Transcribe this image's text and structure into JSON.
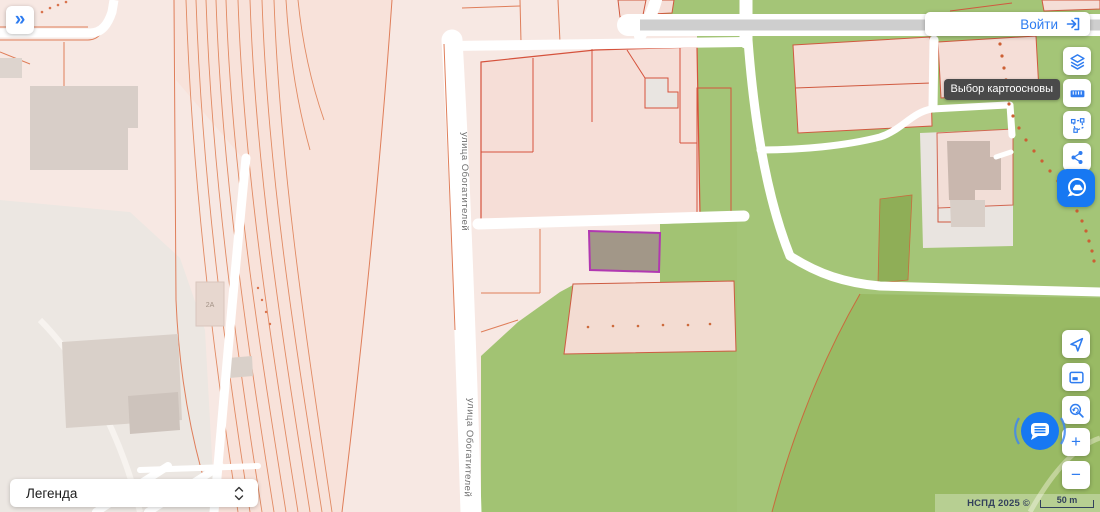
{
  "panel": {
    "collapse_icon": "»"
  },
  "auth": {
    "login_label": "Войти"
  },
  "toolbar": {
    "tooltip": "Выбор картоосновы",
    "buttons": [
      "layers",
      "ruler",
      "polygon-select",
      "share",
      "panorama"
    ]
  },
  "map_controls": {
    "zoom_in": "+",
    "zoom_out": "−",
    "buttons": [
      "locate",
      "overview-map",
      "zoom-extent",
      "zoom-in",
      "zoom-out",
      "chat"
    ]
  },
  "legend": {
    "label": "Легенда"
  },
  "map": {
    "street_label_top": "улица Обогатителей",
    "street_label_bottom": "улица Обогатителей",
    "building_label": "2А"
  },
  "attribution": {
    "text": "НСПД 2025 ©",
    "scale_label": "50 m"
  },
  "colors": {
    "accent": "#2e7cf0",
    "panorama_bg": "#1778f2",
    "tooltip_bg": "#4a4a4a",
    "selection_stroke": "#b138b1",
    "parcel_stroke": "#d0523a",
    "green": "#a4c577",
    "pink_base": "#f7e8e3"
  }
}
